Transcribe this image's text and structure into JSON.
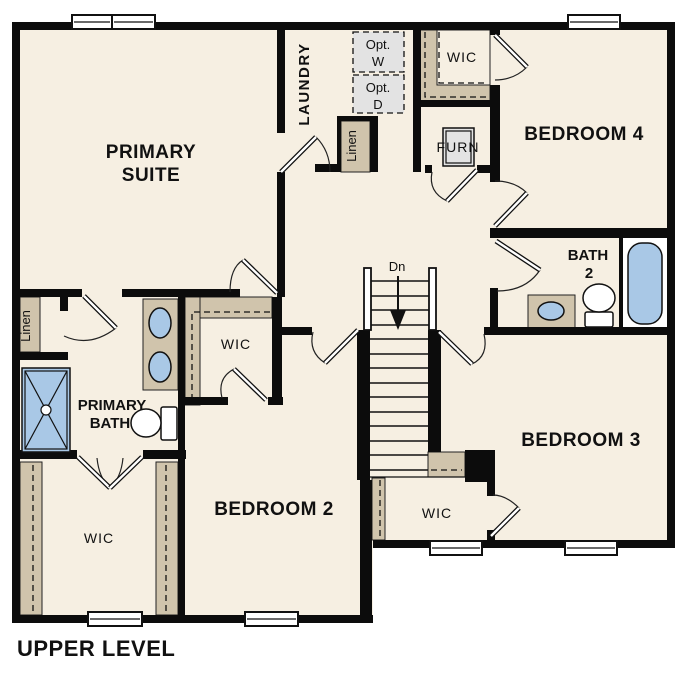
{
  "title": "UPPER LEVEL",
  "rooms": {
    "primary_suite": {
      "line1": "PRIMARY",
      "line2": "SUITE"
    },
    "laundry": {
      "label": "LAUNDRY"
    },
    "bedroom_2": {
      "label": "BEDROOM 2"
    },
    "bedroom_3": {
      "label": "BEDROOM 3"
    },
    "bedroom_4": {
      "label": "BEDROOM 4"
    },
    "primary_bath": {
      "line1": "PRIMARY",
      "line2": "BATH"
    },
    "bath_2": {
      "line1": "BATH",
      "line2": "2"
    },
    "wic_upper": {
      "label": "WIC"
    },
    "wic_primary": {
      "label": "WIC"
    },
    "wic_lower": {
      "label": "WIC"
    },
    "wic_bedroom_3": {
      "label": "WIC"
    },
    "linen_upper": {
      "label": "Linen"
    },
    "linen_lower": {
      "label": "Linen"
    },
    "furnace": {
      "label": "FURN"
    },
    "optional_washer": {
      "line1": "Opt.",
      "line2": "W"
    },
    "optional_dryer": {
      "line1": "Opt.",
      "line2": "D"
    },
    "stairs": {
      "label": "Dn"
    }
  },
  "colors": {
    "floor": "#f6efe2",
    "wall": "#0c0c0c",
    "cabinet": "#d0c4ac",
    "fixture": "#a9c8e6",
    "appliance": "#e3e3e3",
    "text": "#111111"
  }
}
